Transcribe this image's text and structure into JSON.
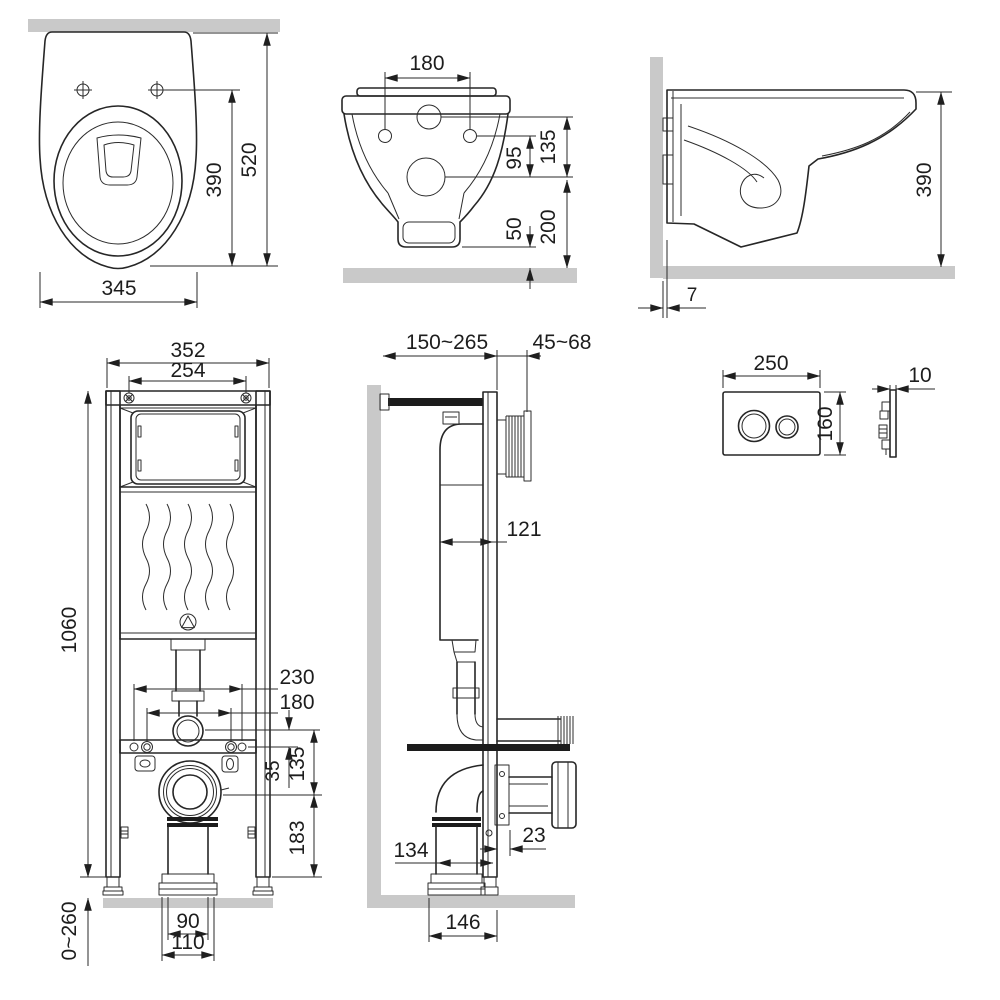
{
  "palette": {
    "line": "#262626",
    "dim_text": "#1d1d1d",
    "surface_gray": "#c9c9c9",
    "background": "#ffffff"
  },
  "views": {
    "toilet_top": {
      "dims": {
        "overall_width": "345",
        "holes_to_front": "390",
        "wall_to_front": "520"
      }
    },
    "toilet_front": {
      "dims": {
        "bolt_spacing": "180",
        "inlet_to_drain": "135",
        "bolts_to_drain": "95",
        "drain_to_floor": "200",
        "outlet_to_floor": "50"
      }
    },
    "toilet_side": {
      "dims": {
        "height": "390",
        "wall_gap": "7"
      }
    },
    "frame_front": {
      "dims": {
        "frame_width": "352",
        "panel_width": "254",
        "frame_height": "1060",
        "anchor_spacing": "230",
        "stud_spacing": "180",
        "flush_to_bar": "35",
        "flush_to_drain": "135",
        "drain_to_base": "183",
        "leg_adjustment": "0~260",
        "outlet_width": "90",
        "outlet_flange_width": "110"
      }
    },
    "frame_side": {
      "dims": {
        "wall_to_frame_front": "150~265",
        "panel_depth": "45~68",
        "cistern_depth": "121",
        "outlet_to_frame": "134",
        "rail_depth": "23",
        "floor_outlet_span": "146"
      }
    },
    "flush_plate": {
      "dims": {
        "width": "250",
        "height": "160",
        "thickness": "10"
      }
    }
  }
}
